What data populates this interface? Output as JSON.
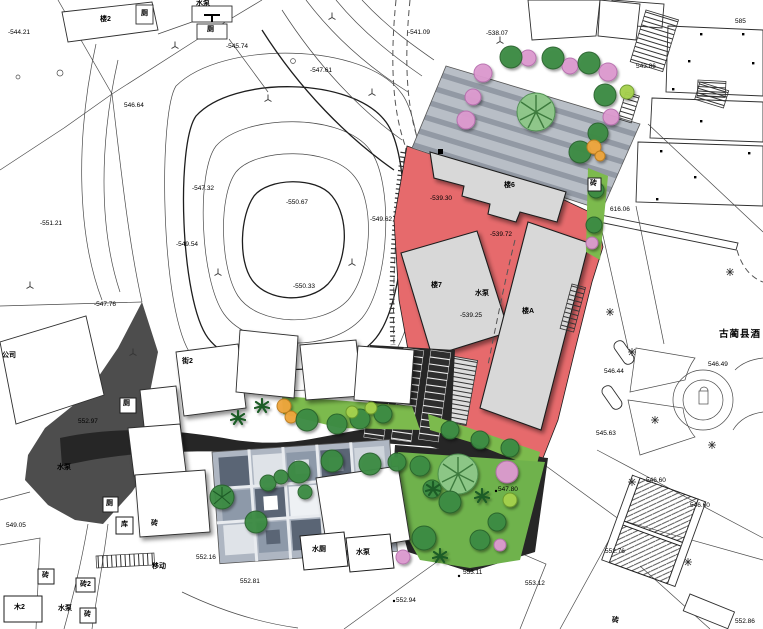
{
  "map": {
    "colors": {
      "red_zone": "#e66a6c",
      "asphalt": "#262626",
      "plaza_base": "#b8bec6",
      "plaza_stripe": "#9299a4",
      "green_area": "#7cba4d",
      "dark_existing_mass": "#4d4d4d",
      "building_grey": "#d8d8d8",
      "tree_pink": "#dd9bd0",
      "tree_orange": "#efa63d",
      "paving_dark_tile": "#5a6575"
    },
    "icons": {
      "grass_symbol": "⏊",
      "tree_star_symbol": "✳",
      "pump_t_symbol": "T"
    },
    "labels": {
      "elev_n544_21": "-544.21",
      "bldg_lou2": "楼2",
      "ce_top_box": "厕",
      "pump_top": "水泵",
      "ce_pump_box": "厕",
      "elev_n545_74": "-545.74",
      "elev_546_64": "546.64",
      "elev_n547_61": "-547.61",
      "elev_n541_09": "-541.09",
      "elev_n538_07": "-538.07",
      "elev_543_86": "543.86",
      "elev_585": "585",
      "elev_n551_21": "-551.21",
      "elev_n550_67": "-550.67",
      "elev_n549_62": "-549.62",
      "elev_n550_33": "-550.33",
      "elev_n549_54": "-549.54",
      "elev_n547_32": "-547.32",
      "elev_n547_76": "-547.76",
      "gongsi": "公司",
      "elev_552_97": "552.97",
      "pump_dark": "水泵",
      "elev_549_05": "549.05",
      "ce_bl": "厕",
      "ku_bl": "库",
      "zhuan_bl1": "砖",
      "zhuan_bl2": "砖",
      "zhuan2_bl": "砖2",
      "mu2_bl": "木2",
      "pump_bl": "水泵",
      "zhuan_bl3": "砖",
      "yidong": "移动",
      "elev_552_16": "552.16",
      "elev_552_81": "552.81",
      "shuice_box": "水厕",
      "pump_bc_box": "水泵",
      "elev_553_11": "553.11",
      "elev_553_12": "553.12",
      "elev_552_94": "552.94",
      "elev_547_80": "547.80",
      "elev_616_06": "616.06",
      "gulin_county": "古蔺县酒",
      "elev_546_44": "546.44",
      "elev_546_49": "546.49",
      "elev_545_63": "545.63",
      "elev_546_60a": "546.60",
      "elev_546_60b": "546.60",
      "elev_552_76": "552.76",
      "elev_552_86": "552.86",
      "zhuan_br": "砖",
      "bldg_lou6": "楼6",
      "elev_n539_30": "-539.30",
      "elev_n539_72": "-539.72",
      "bldg_lou7": "楼7",
      "pump_red": "水泵",
      "elev_n539_25": "-539.25",
      "bldg_louA": "楼A",
      "jie2": "街2",
      "zhuan_mid": "砖",
      "ce_mid": "厕"
    }
  }
}
